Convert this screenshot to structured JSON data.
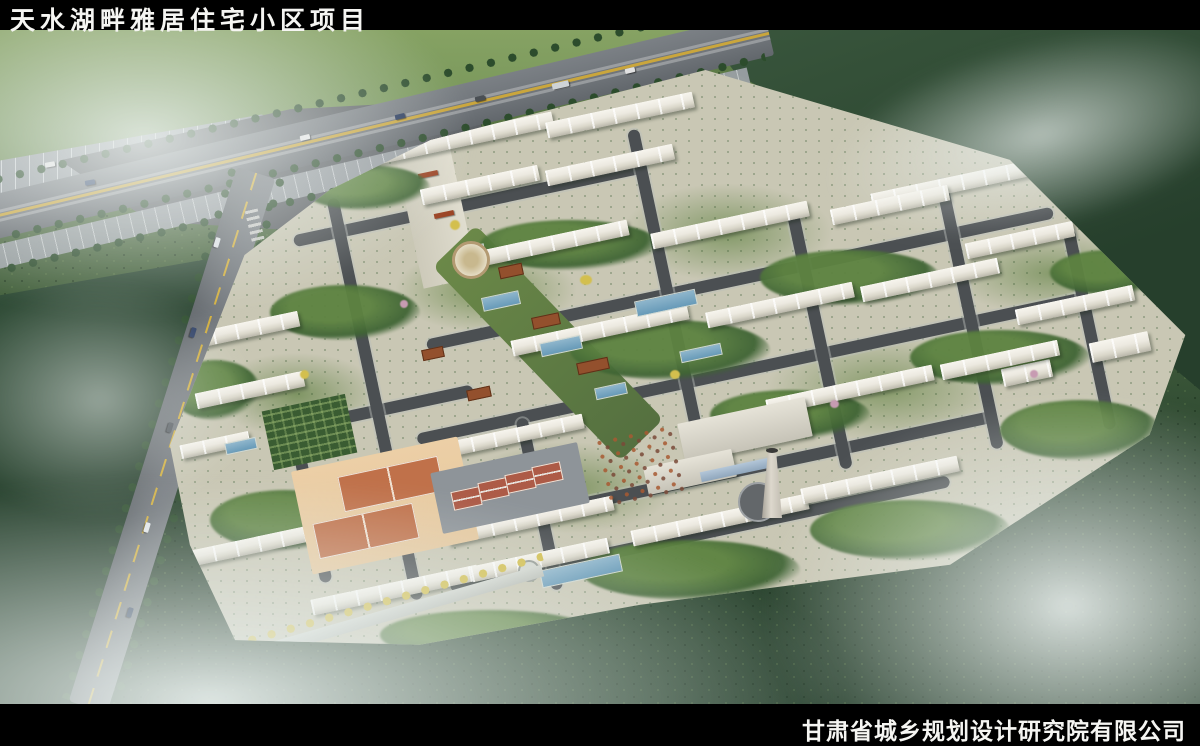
{
  "header": {
    "title": "天水湖畔雅居住宅小区项目"
  },
  "footer": {
    "company": "甘肃省城乡规划设计研究院有限公司"
  },
  "palette": {
    "bar": "#000000",
    "text": "#f5f5f2",
    "forest": "#3d5a3d",
    "forest_dark": "#2c4531",
    "canopy_light": "#7d9b5c",
    "lawn": "#6c8a4a",
    "road": "#70757a",
    "inner_road": "#4b4f52",
    "plaza": "#5d6165",
    "site": "#c9c7b4",
    "building": "#ece9e0",
    "water": "#679ab8",
    "corten": "#93502d",
    "basketball": "#c0714a",
    "tennis": "#ad5b47",
    "apron": "#e6c89e",
    "yellow_tree": "#d3bf4e",
    "blossom": "#c79bb2",
    "fog": "#e9f0ee",
    "chimney": "#ddd8cd"
  }
}
